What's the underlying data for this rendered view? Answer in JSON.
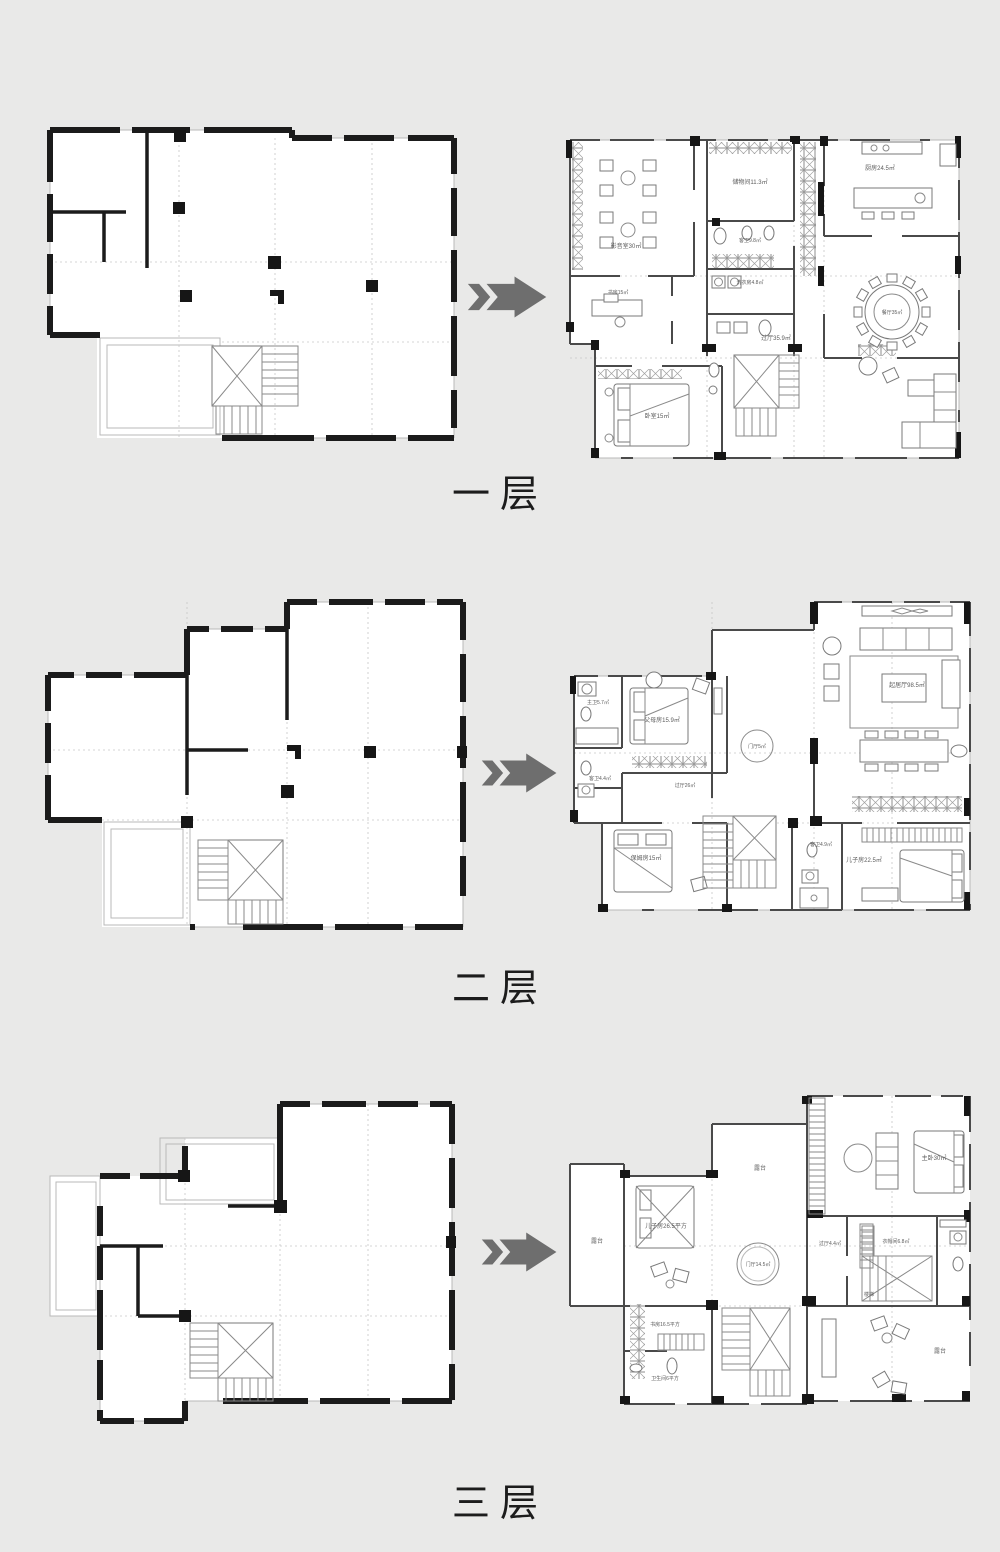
{
  "page": {
    "background": "#e9e9e8"
  },
  "arrow_color": "#6e6e6e",
  "rows": [
    {
      "id": "floor-1",
      "floor_label": "一层",
      "after_rooms": {
        "media": "影音室30㎡",
        "storage": "储物间11.3㎡",
        "kitchen": "厨房24.5㎡",
        "guest_bath": "客卫9.8㎡",
        "laundry": "洗衣房4.8㎡",
        "dining": "餐厅35㎡",
        "hall": "过厅35.9㎡",
        "study": "书房15㎡",
        "bedroom": "卧室15㎡"
      }
    },
    {
      "id": "floor-2",
      "floor_label": "二层",
      "after_rooms": {
        "family": "起居厅98.5㎡",
        "parents": "父母房15.9㎡",
        "master_bath": "主卫5.7㎡",
        "guest_bath": "客卫4.4㎡",
        "nanny": "保姆房15㎡",
        "hall": "过厅26㎡",
        "foyer": "门厅5㎡",
        "son": "儿子房22.5㎡",
        "son_bath": "客卫4.9㎡"
      }
    },
    {
      "id": "floor-3",
      "floor_label": "三层",
      "after_rooms": {
        "terrace_top": "露台",
        "terrace_left": "露台",
        "terrace_bottom": "露台",
        "master": "主卧30㎡",
        "son": "儿子房26.5平方",
        "foyer": "门厅14.5㎡",
        "hall": "过厅4.4㎡",
        "cloak": "衣帽间6.8㎡",
        "study": "书房16.5平方",
        "bath": "卫生间6平方",
        "stair": "楼梯"
      }
    }
  ]
}
